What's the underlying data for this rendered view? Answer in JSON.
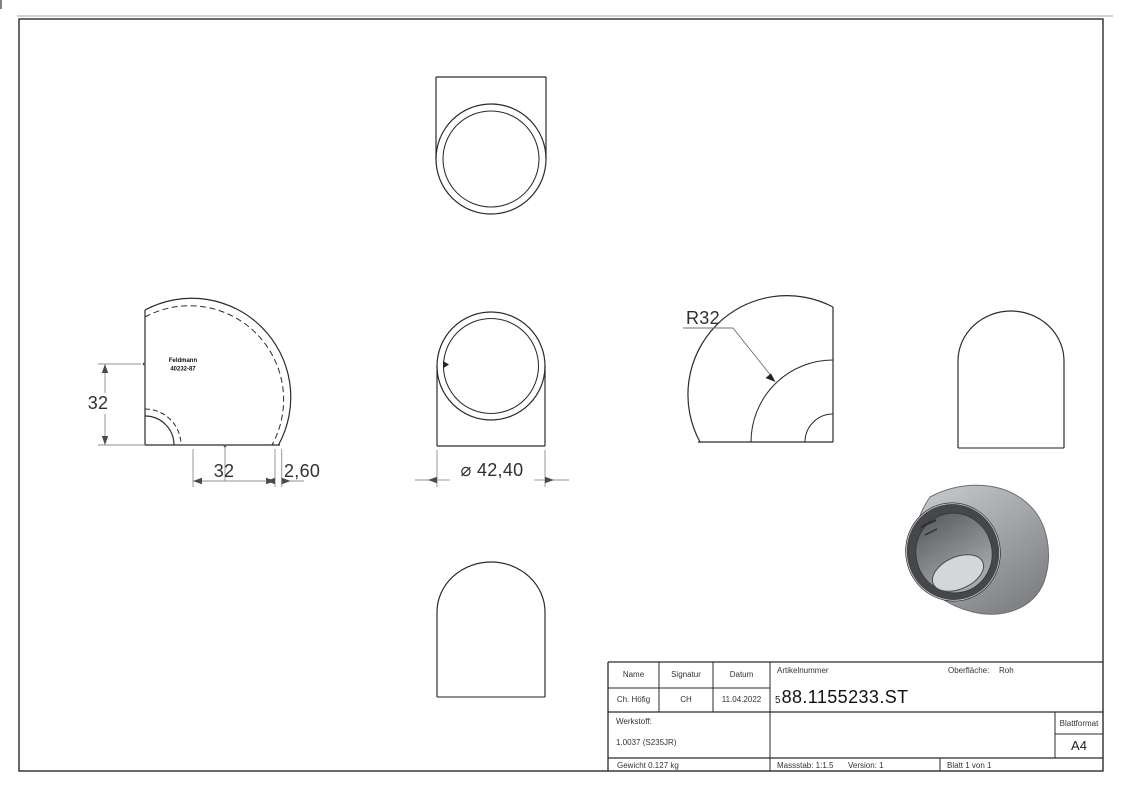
{
  "drawing": {
    "dimensions": {
      "height_32": "32",
      "width_32": "32",
      "wall_thickness": "2,60",
      "outer_diameter": "⌀ 42,40",
      "bend_radius": "R32"
    },
    "stamp": {
      "line1": "Feldmann",
      "line2": "40232-87"
    },
    "title_block": {
      "name_label": "Name",
      "signatur_label": "Signatur",
      "datum_label": "Datum",
      "name_value": "Ch. Höfig",
      "signatur_value": "CH",
      "datum_value": "11.04.2022",
      "artikelnummer_label": "Artikelnummer",
      "artikelnummer_prefix": "5",
      "artikelnummer_value": "88.1155233.ST",
      "oberflaeche_label": "Oberfläche:",
      "oberflaeche_value": "Roh",
      "werkstoff_label": "Werkstoff:",
      "werkstoff_value": "1.0037 (S235JR)",
      "blattformat_label": "Blattformat",
      "blattformat_value": "A4",
      "gewicht": "Gewicht 0.127 kg",
      "massstab": "Massstab: 1:1.5",
      "version": "Version: 1",
      "blatt": "Blatt 1 von 1"
    },
    "colors": {
      "line": "#2b2b2b",
      "dim_line": "#8a8a8a",
      "metal_light": "#c6c8ca",
      "metal_dark": "#85878a"
    }
  }
}
